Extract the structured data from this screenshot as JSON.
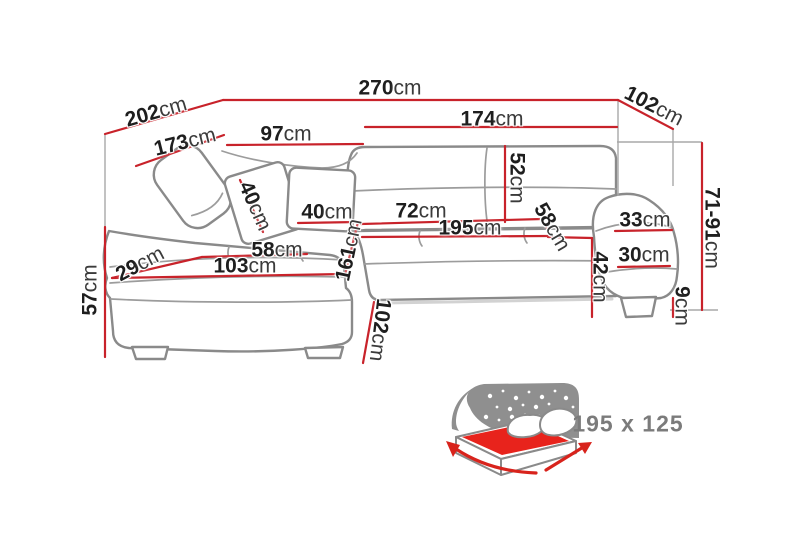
{
  "diagram": {
    "description": "Corner sofa technical dimension drawing with storage bed function",
    "unit_default": "cm",
    "colors": {
      "dimension_line": "#c8222a",
      "sofa_outline": "#8a8a8a",
      "label_text": "#1e1e1e",
      "bed_label_text": "#7b7b7b",
      "bed_mattress_red": "#e8231c"
    },
    "dims": {
      "total_width": {
        "v": "270",
        "u": "cm"
      },
      "left_side_outer": {
        "v": "202",
        "u": "cm"
      },
      "left_side_inner": {
        "v": "173",
        "u": "cm"
      },
      "left_back_width": {
        "v": "97",
        "u": "cm"
      },
      "right_back_width": {
        "v": "174",
        "u": "cm"
      },
      "right_side_depth": {
        "v": "102",
        "u": "cm"
      },
      "height_range": {
        "v": "71-91",
        "u": "cm"
      },
      "backrest_height": {
        "v": "52",
        "u": "cm"
      },
      "headrest_pillow": {
        "v": "40",
        "u": "cm"
      },
      "back_pillow": {
        "v": "40",
        "u": "cm"
      },
      "seat_depth": {
        "v": "72",
        "u": "cm"
      },
      "sleeping_length": {
        "v": "195",
        "u": "cm"
      },
      "corner_seat_width": {
        "v": "58",
        "u": "cm"
      },
      "armrest_top_width": {
        "v": "33",
        "u": "cm"
      },
      "armrest_front_width": {
        "v": "30",
        "u": "cm"
      },
      "seat_height": {
        "v": "42",
        "u": "cm"
      },
      "leg_height": {
        "v": "9",
        "u": "cm"
      },
      "chaise_height": {
        "v": "57",
        "u": "cm"
      },
      "chaise_corner_depth": {
        "v": "29",
        "u": "cm"
      },
      "chaise_seat_width": {
        "v": "58",
        "u": "cm"
      },
      "chaise_front_width": {
        "v": "103",
        "u": "cm"
      },
      "chaise_length": {
        "v": "161",
        "u": "cm"
      },
      "chaise_side_depth": {
        "v": "102",
        "u": "cm"
      }
    },
    "bed_function": {
      "size_label": "195 x 125",
      "icon": "storage-bed-icon"
    }
  }
}
